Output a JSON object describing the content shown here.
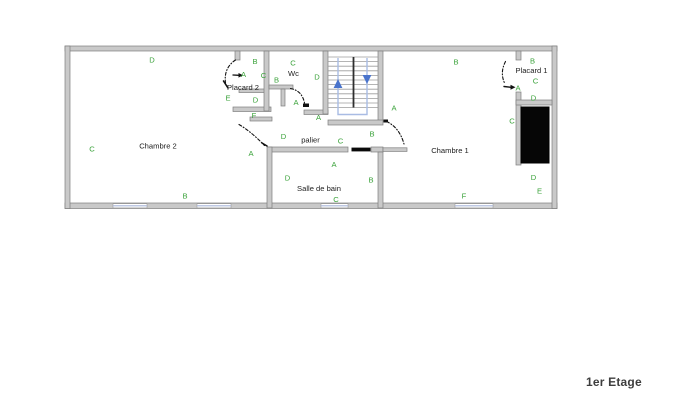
{
  "title": "1er Etage",
  "colors": {
    "wall_fill": "#c9c9c9",
    "wall_stroke": "#7e7e7e",
    "label_green": "#3aa23a",
    "room_text": "#222222",
    "window_blue": "#a9b6da",
    "stair_tread": "#9c9c9c",
    "stair_divider": "#2e2e2e",
    "stair_guide": "#a9bce4",
    "stair_arrow": "#4a74cc",
    "duct_black": "#060606",
    "door_line": "#111111",
    "title_color": "#3d3d3d"
  },
  "icons": {
    "stairs_up": "up-arrow",
    "stairs_down": "down-arrow"
  },
  "rooms": [
    {
      "name": "Chambre 2",
      "x": 158,
      "y": 146
    },
    {
      "name": "Chambre 1",
      "x": 450,
      "y": 150.5
    },
    {
      "name": "Salle de bain",
      "x": 319,
      "y": 188.5
    },
    {
      "name": "palier",
      "x": 310.5,
      "y": 140
    },
    {
      "name": "Wc",
      "x": 293.5,
      "y": 73.5
    },
    {
      "name": "Placard 2",
      "x": 243,
      "y": 87.5
    },
    {
      "name": "Placard 1",
      "x": 531.5,
      "y": 70.5
    }
  ],
  "wall_labels": [
    {
      "text": "D",
      "x": 152,
      "y": 60
    },
    {
      "text": "B",
      "x": 255,
      "y": 61.5
    },
    {
      "text": "A",
      "x": 243.5,
      "y": 74.5
    },
    {
      "text": "C",
      "x": 263.5,
      "y": 75.5
    },
    {
      "text": "E",
      "x": 228,
      "y": 98
    },
    {
      "text": "D",
      "x": 255.5,
      "y": 100
    },
    {
      "text": "F",
      "x": 254,
      "y": 115.5
    },
    {
      "text": "C",
      "x": 293,
      "y": 63
    },
    {
      "text": "B",
      "x": 276.5,
      "y": 80
    },
    {
      "text": "D",
      "x": 317,
      "y": 77
    },
    {
      "text": "A",
      "x": 296,
      "y": 102.5
    },
    {
      "text": "A",
      "x": 318.5,
      "y": 117.5
    },
    {
      "text": "C",
      "x": 92,
      "y": 149
    },
    {
      "text": "A",
      "x": 251,
      "y": 153.5
    },
    {
      "text": "B",
      "x": 185,
      "y": 196
    },
    {
      "text": "D",
      "x": 283.5,
      "y": 136.5
    },
    {
      "text": "C",
      "x": 340.5,
      "y": 141
    },
    {
      "text": "B",
      "x": 372,
      "y": 134
    },
    {
      "text": "A",
      "x": 394,
      "y": 108
    },
    {
      "text": "B",
      "x": 456,
      "y": 62
    },
    {
      "text": "B",
      "x": 532.5,
      "y": 61
    },
    {
      "text": "C",
      "x": 535.5,
      "y": 81
    },
    {
      "text": "A",
      "x": 518,
      "y": 88
    },
    {
      "text": "D",
      "x": 533.5,
      "y": 98
    },
    {
      "text": "C",
      "x": 512,
      "y": 121
    },
    {
      "text": "A",
      "x": 334,
      "y": 164.5
    },
    {
      "text": "D",
      "x": 287.5,
      "y": 178
    },
    {
      "text": "B",
      "x": 371,
      "y": 180
    },
    {
      "text": "C",
      "x": 336,
      "y": 199.5
    },
    {
      "text": "F",
      "x": 464,
      "y": 196
    },
    {
      "text": "D",
      "x": 533.5,
      "y": 177.5
    },
    {
      "text": "E",
      "x": 539.5,
      "y": 191
    }
  ]
}
